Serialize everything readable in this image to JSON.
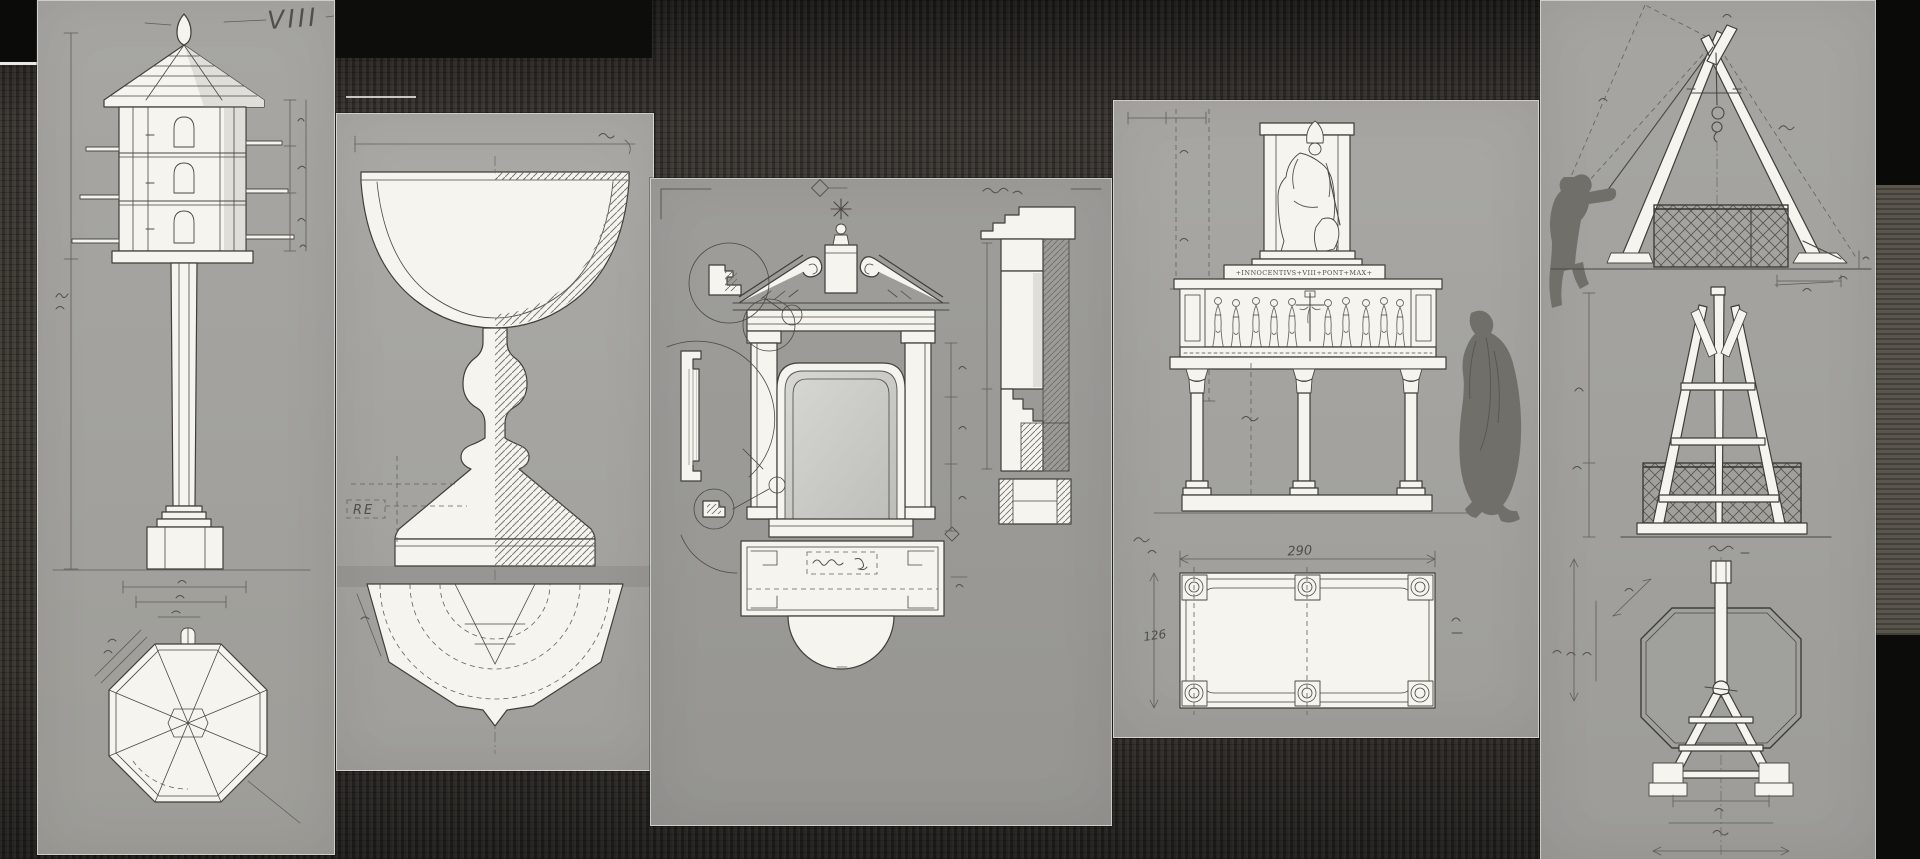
{
  "scene": {
    "description": "Collage of pencil measured-drawing sheets pinned on a dark woven cloth background",
    "colors": {
      "background_cloth": "#38352f",
      "paper_gray": "#a5a4a0",
      "pencil": "#4a4843",
      "drawing_white": "#f5f4ef",
      "silhouette_gray": "#716f6a",
      "black_patch": "#0b0b0a"
    }
  },
  "sheets": {
    "dovecote": {
      "plate_label": "VIII"
    },
    "chalice": {
      "note_label": "RE"
    },
    "aedicule": {},
    "monument": {
      "inscription": "+INNOCENTIVS+VIII+PONT+MAX+",
      "plan_width": "290",
      "plan_side": "126"
    },
    "rigging": {}
  }
}
